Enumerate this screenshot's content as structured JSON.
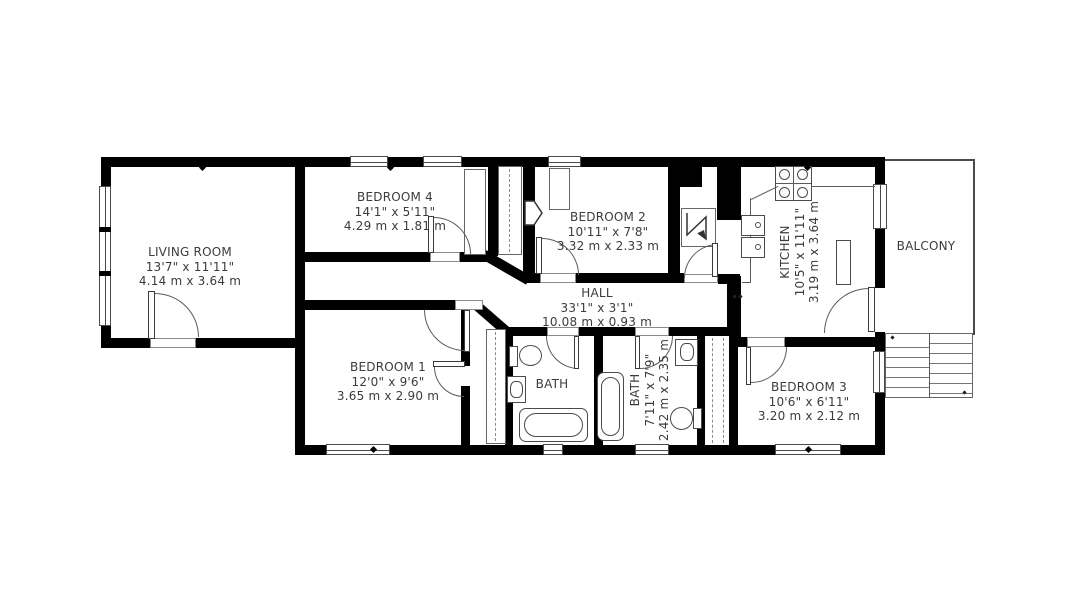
{
  "colors": {
    "wall": "#000000",
    "background": "#ffffff",
    "line": "#555555",
    "text": "#3c3c3c"
  },
  "rooms": {
    "living": {
      "name": "LIVING ROOM",
      "imperial": "13'7\" x 11'11\"",
      "metric": "4.14 m x 3.64 m"
    },
    "bedroom4": {
      "name": "BEDROOM 4",
      "imperial": "14'1\" x 5'11\"",
      "metric": "4.29 m x 1.81 m"
    },
    "bedroom2": {
      "name": "BEDROOM 2",
      "imperial": "10'11\" x 7'8\"",
      "metric": "3.32 m x 2.33 m"
    },
    "kitchen": {
      "name": "KITCHEN",
      "imperial": "10'5\" x 11'11\"",
      "metric": "3.19 m x 3.64 m"
    },
    "balcony": {
      "name": "BALCONY"
    },
    "hall": {
      "name": "HALL",
      "imperial": "33'1\" x 3'1\"",
      "metric": "10.08 m x 0.93 m"
    },
    "bedroom1": {
      "name": "BEDROOM 1",
      "imperial": "12'0\" x 9'6\"",
      "metric": "3.65 m x 2.90 m"
    },
    "bath1": {
      "name": "BATH"
    },
    "bath2": {
      "name": "BATH",
      "imperial": "7'11\" x 7'9\"",
      "metric": "2.42 m x 2.35 m"
    },
    "bedroom3": {
      "name": "BEDROOM 3",
      "imperial": "10'6\" x 6'11\"",
      "metric": "3.20 m x 2.12 m"
    }
  }
}
